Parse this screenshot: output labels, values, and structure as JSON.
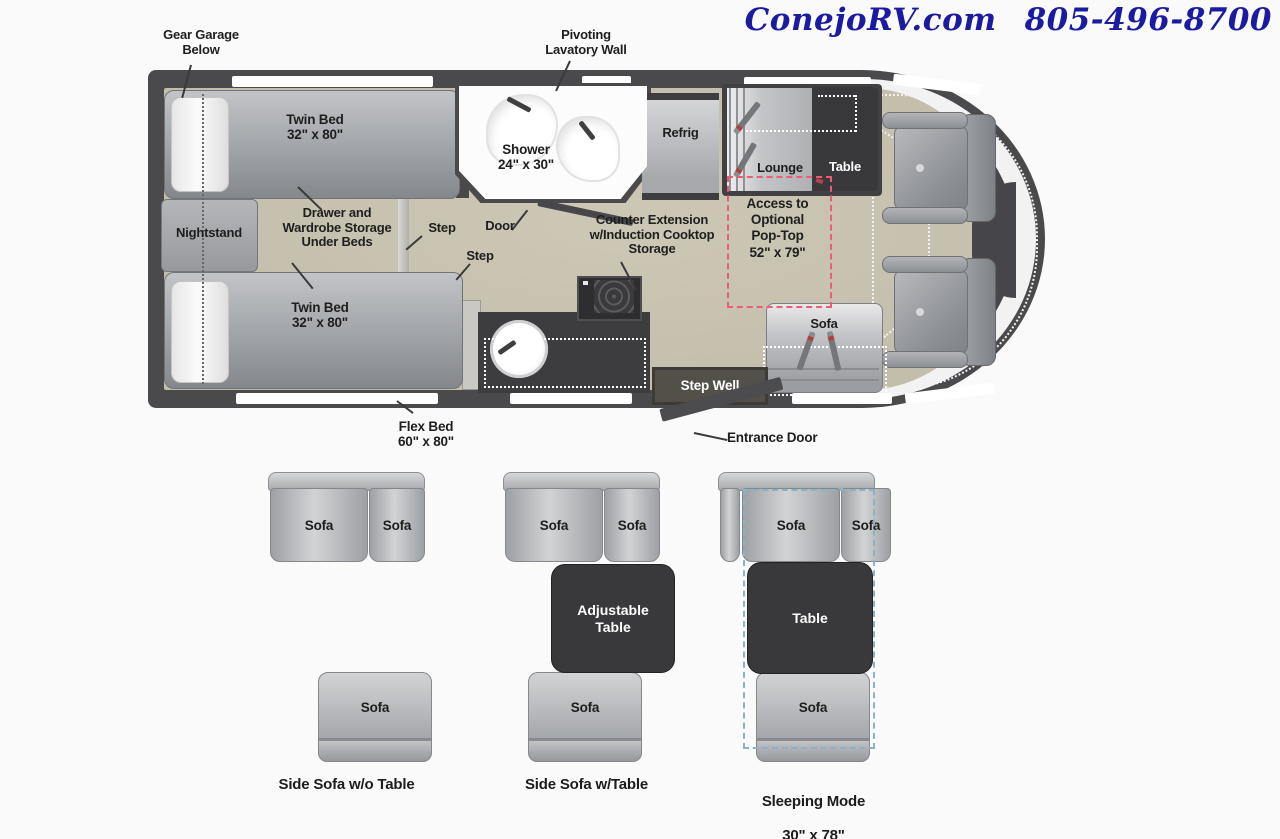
{
  "header": {
    "brand": "ConejoRV.com",
    "phone": "805-496-8700"
  },
  "floorplan": {
    "gear_garage": "Gear Garage\nBelow",
    "pivoting_lavatory": "Pivoting\nLavatory Wall",
    "twin_bed_top": "Twin Bed\n32\" x 80\"",
    "twin_bed_bottom": "Twin Bed\n32\" x 80\"",
    "nightstand": "Nightstand",
    "under_bed_storage": "Drawer and\nWardrobe Storage\nUnder Beds",
    "step_upper": "Step",
    "step_lower": "Step",
    "door": "Door",
    "shower": "Shower\n24\" x 30\"",
    "refrig": "Refrig",
    "counter_extension": "Counter Extension\nw/Induction Cooktop\nStorage",
    "lounge": "Lounge",
    "table": "Table",
    "pop_top": "Access to\nOptional\nPop-Top\n52\" x 79\"",
    "sofa": "Sofa",
    "step_well": "Step Well",
    "entrance_door": "Entrance Door",
    "flex_bed": "Flex Bed\n60\" x 80\""
  },
  "configurations": [
    {
      "seat_left": "Sofa",
      "seat_right": "Sofa",
      "side_seat": "Sofa",
      "caption": "Side Sofa w/o Table"
    },
    {
      "seat_left": "Sofa",
      "seat_right": "Sofa",
      "table": "Adjustable\nTable",
      "side_seat": "Sofa",
      "caption": "Side Sofa w/Table"
    },
    {
      "seat_left": "Sofa",
      "seat_right": "Sofa",
      "table": "Table",
      "side_seat": "Sofa",
      "caption": "Sleeping Mode",
      "caption_size": "30\" x 78\""
    }
  ],
  "colors": {
    "header_blue": "#1b1ba2",
    "wall_gray": "#4a4a4c",
    "floor_tan": "#c5bfad",
    "panel_dark": "#39393b",
    "poptop_pink": "#ea5d74",
    "sleep_dashed_blue": "#8ab2c8"
  }
}
